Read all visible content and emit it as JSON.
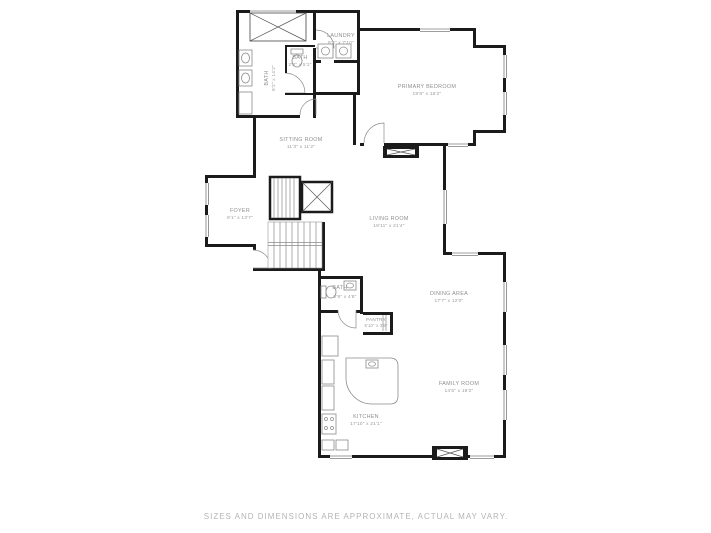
{
  "disclaimer": "SIZES AND DIMENSIONS ARE APPROXIMATE, ACTUAL MAY VARY.",
  "rooms": {
    "closet_bath": {
      "name": "BATH",
      "dims": "9'2\" x 14'2\""
    },
    "bath_small": {
      "name": "BATH",
      "dims": "2'3\" x 5'1\""
    },
    "laundry": {
      "name": "LAUNDRY",
      "dims": "8'3\" x 7'10\""
    },
    "primary_bedroom": {
      "name": "PRIMARY BEDROOM",
      "dims": "19'8\" x 16'2\""
    },
    "sitting_room": {
      "name": "SITTING ROOM",
      "dims": "11'3\" x 11'2\""
    },
    "living_room": {
      "name": "LIVING ROOM",
      "dims": "19'11\" x 21'4\""
    },
    "foyer": {
      "name": "FOYER",
      "dims": "9'1\" x 13'7\""
    },
    "bath_lower": {
      "name": "BATH",
      "dims": "6'9\" x 4'8\""
    },
    "pantry": {
      "name": "PANTRY",
      "dims": "5'10\" x 3'9\""
    },
    "dining_area": {
      "name": "DINING AREA",
      "dims": "17'7\" x 12'0\""
    },
    "kitchen": {
      "name": "KITCHEN",
      "dims": "17'10\" x 21'1\""
    },
    "family_room": {
      "name": "FAMILY ROOM",
      "dims": "14'5\" x 19'2\""
    }
  },
  "colors": {
    "wall": "#1b1b1b",
    "label": "#8f8f8f",
    "fixture": "#8a8a8a",
    "disclaimer": "#b4b4b4"
  }
}
